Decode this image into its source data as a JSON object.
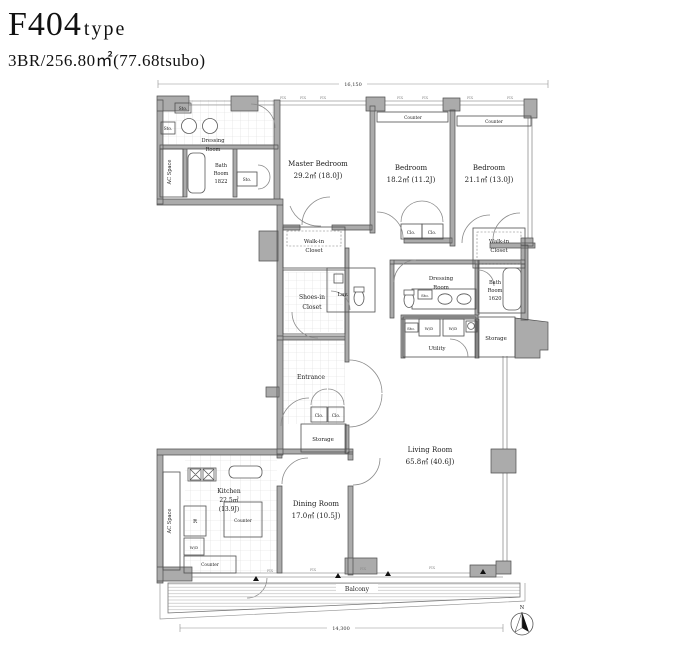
{
  "header": {
    "title": "F404",
    "title_suffix": "type",
    "subtitle": "3BR/256.80㎡(77.68tsubo)"
  },
  "rooms": {
    "dressing_top": {
      "line1": "Dressing",
      "line2": "Room"
    },
    "ac_space_top": {
      "name": "AC Space"
    },
    "bath_top": {
      "line1": "Bath",
      "line2": "Room",
      "line3": "1822"
    },
    "master_bedroom": {
      "name": "Master Bedroom",
      "area": "29.2㎡ (18.0J)"
    },
    "bedroom_center": {
      "name": "Bedroom",
      "area": "18.2㎡ (11.2J)"
    },
    "bedroom_right": {
      "name": "Bedroom",
      "area": "21.1㎡ (13.0J)"
    },
    "wic_left": {
      "line1": "Walk-in",
      "line2": "Closet"
    },
    "wic_right": {
      "line1": "Walk-in",
      "line2": "Closet"
    },
    "shoes_closet": {
      "line1": "Shoes-in",
      "line2": "Closet"
    },
    "lav": {
      "name": "Lav."
    },
    "dressing_right": {
      "line1": "Dressing",
      "line2": "Room"
    },
    "bath_right": {
      "line1": "Bath",
      "line2": "Room",
      "line3": "1620"
    },
    "utility": {
      "name": "Utility"
    },
    "storage_right": {
      "name": "Storage"
    },
    "entrance": {
      "name": "Entrance"
    },
    "storage_mid": {
      "name": "Storage"
    },
    "living_room": {
      "name": "Living Room",
      "area": "65.8㎡ (40.6J)"
    },
    "dining_room": {
      "name": "Dining Room",
      "area": "17.0㎡ (10.5J)"
    },
    "kitchen": {
      "name": "Kitchen",
      "area": "22.5㎡",
      "area2": "(13.9J)"
    },
    "ac_space_bottom": {
      "name": "AC Space"
    },
    "balcony": {
      "name": "Balcony"
    }
  },
  "labels": {
    "sto": "Sto.",
    "clo": "Clo.",
    "wd": "W/D",
    "fridge": "R",
    "counter": "Counter",
    "fix": "FIX"
  },
  "dimensions": {
    "top": "16,150",
    "bottom": "14,300"
  },
  "compass": {
    "north": "N"
  },
  "colors": {
    "wall": "#ababab",
    "line": "#4f4f4f"
  }
}
